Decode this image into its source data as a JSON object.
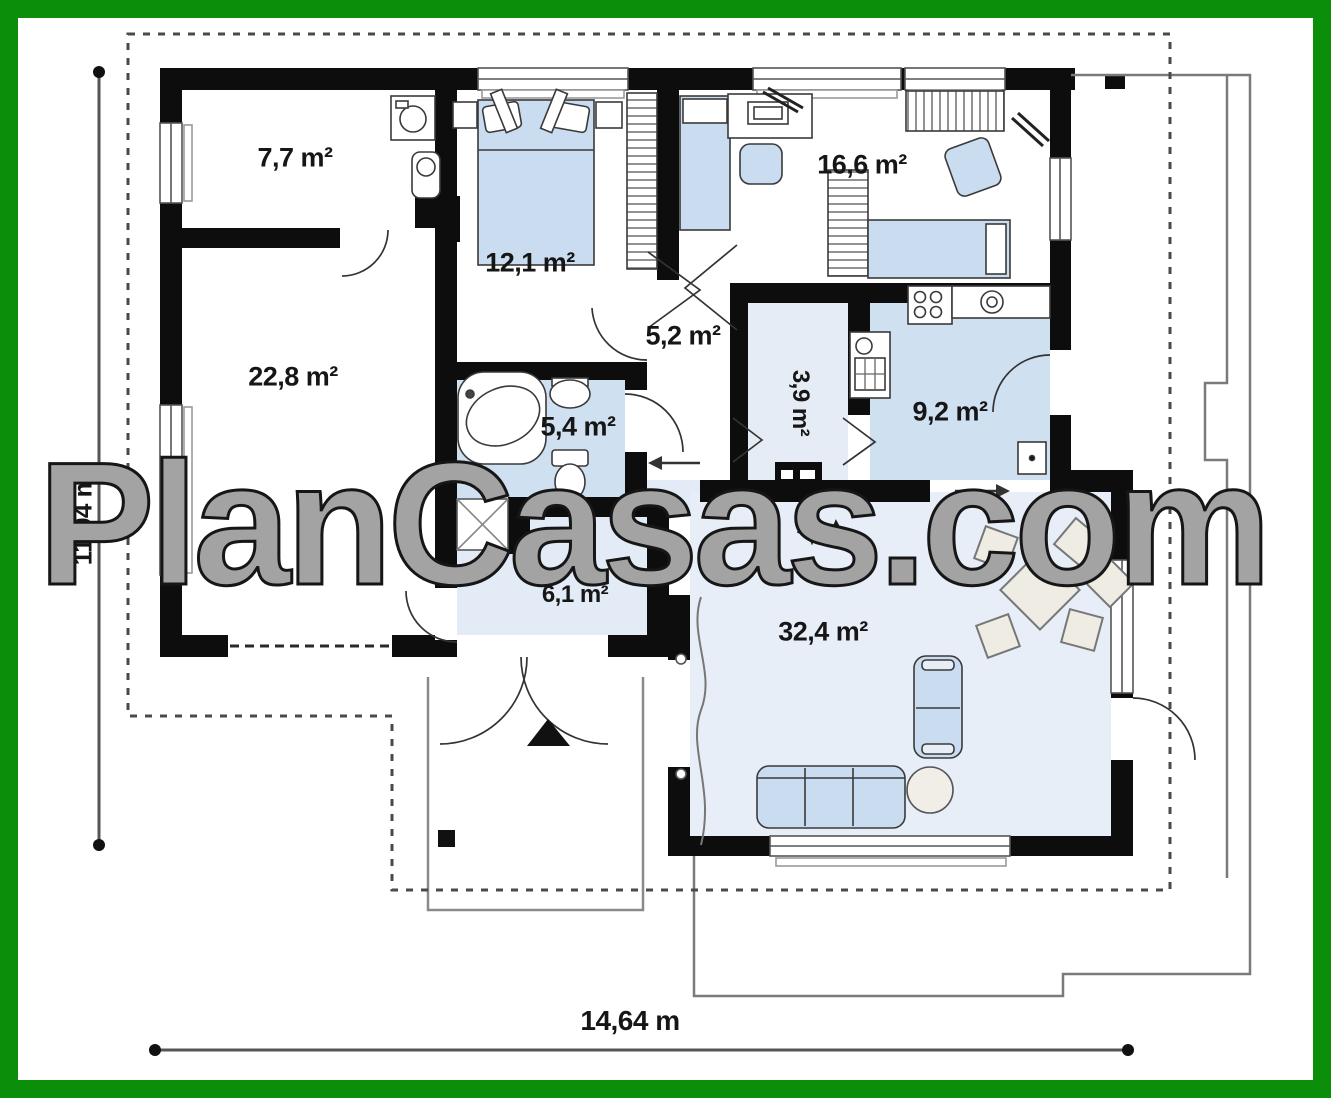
{
  "watermark": {
    "text": "PlanCasas.com"
  },
  "dimensions": {
    "width": "14,64 m",
    "height": "11,94 m"
  },
  "rooms": {
    "utility": "7,7 m²",
    "bedroom1": "12,1 m²",
    "bedroom2": "16,6 m²",
    "garage": "22,8 m²",
    "hall": "5,2 m²",
    "pantry": "3,9 m²",
    "kitchen": "9,2 m²",
    "bathroom": "5,4 m²",
    "entry": "6,1 m²",
    "living": "32,4 m²"
  },
  "colors": {
    "frame_green": "#0b8f0b",
    "wall_black": "#0d0d0d",
    "furniture_blue": "#c9dcf0",
    "floor_tint": "#dce8f5",
    "outline_gray": "#7a7a7a"
  }
}
